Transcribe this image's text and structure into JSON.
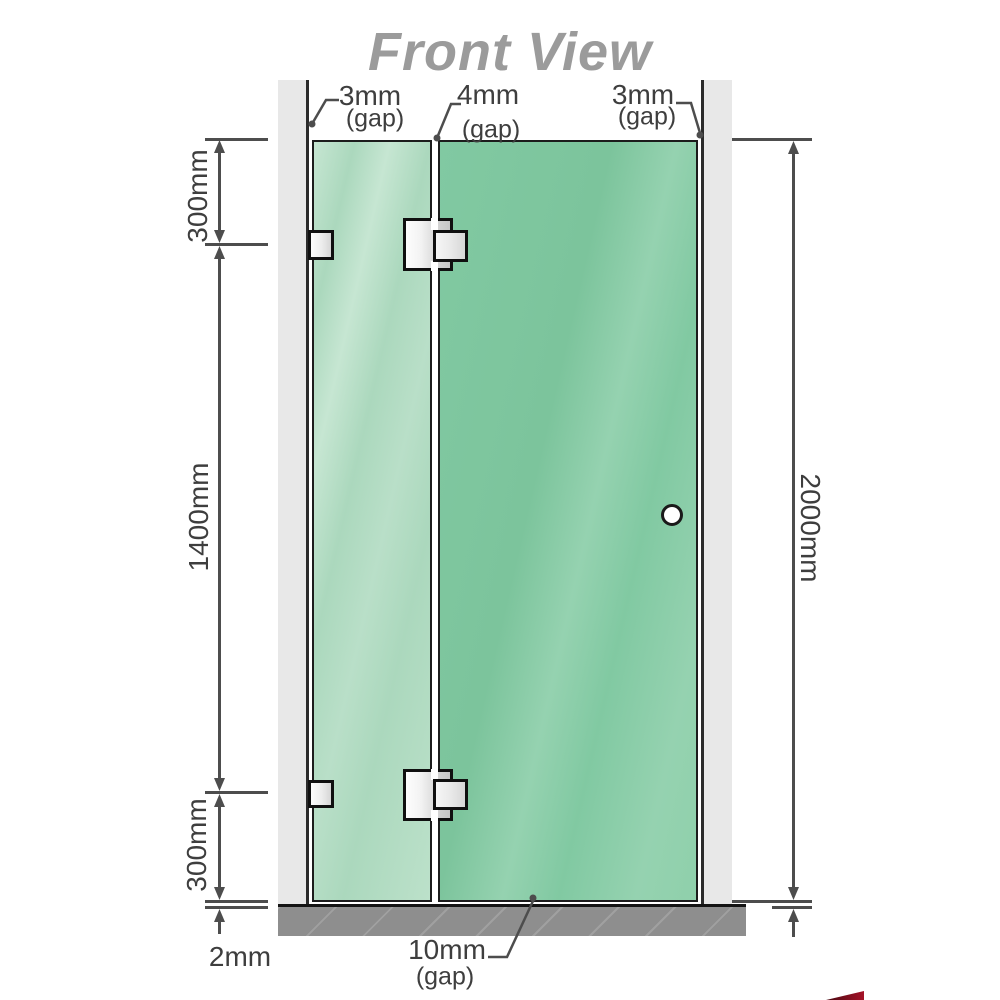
{
  "title": "Front View",
  "dimensions": {
    "top_left_gap_value": "3mm",
    "top_left_gap_label": "(gap)",
    "top_middle_gap_value": "4mm",
    "top_middle_gap_label": "(gap)",
    "top_right_gap_value": "3mm",
    "top_right_gap_label": "(gap)",
    "left_upper_height": "300mm",
    "left_middle_height": "1400mm",
    "left_lower_height": "300mm",
    "right_total_height": "2000mm",
    "floor_clearance": "2mm",
    "bottom_door_gap_value": "10mm",
    "bottom_door_gap_label": "(gap)"
  },
  "colors": {
    "glass-left": "#abd8bd",
    "glass-left-hi": "#c6e6d2",
    "glass-right": "#81c9a2",
    "glass-right-hi": "#95d2b0",
    "wall": "#e8e8e8",
    "wall-edge": "#2b2b2b",
    "floor": "#8e8e8e",
    "dim": "#4d4d4d",
    "label": "#3e3e3e",
    "title": "#9b9b9b",
    "hardware-border": "#101010",
    "logo-red": "#a51228"
  }
}
